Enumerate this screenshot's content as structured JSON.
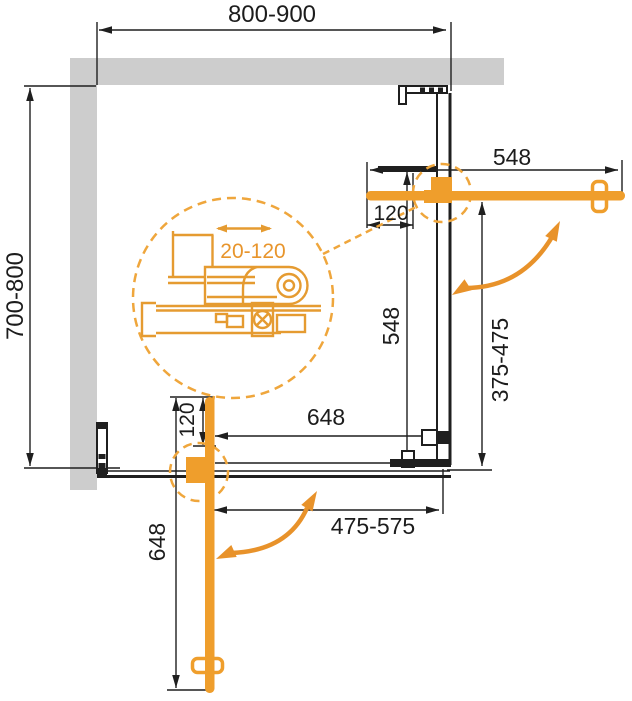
{
  "diagram": {
    "type": "shower-enclosure-installation-top-view",
    "colors": {
      "accent_orange": "#EF9E2C",
      "mechanism_orange": "#E59B31",
      "wall_gray": "#CDCDCD",
      "line_black": "#1F1F1F"
    }
  },
  "labels": {
    "overall_width": "800-900",
    "overall_depth": "700-800",
    "top_door_open_width": "548",
    "top_wall_offset": "120",
    "right_door_closed_width": "548",
    "right_opening_range": "375-475",
    "adjustment_range": "20-120",
    "bottom_door_closed_width": "648",
    "bottom_wall_offset": "120",
    "bottom_door_open_width": "648",
    "bottom_opening_range": "475-575"
  }
}
